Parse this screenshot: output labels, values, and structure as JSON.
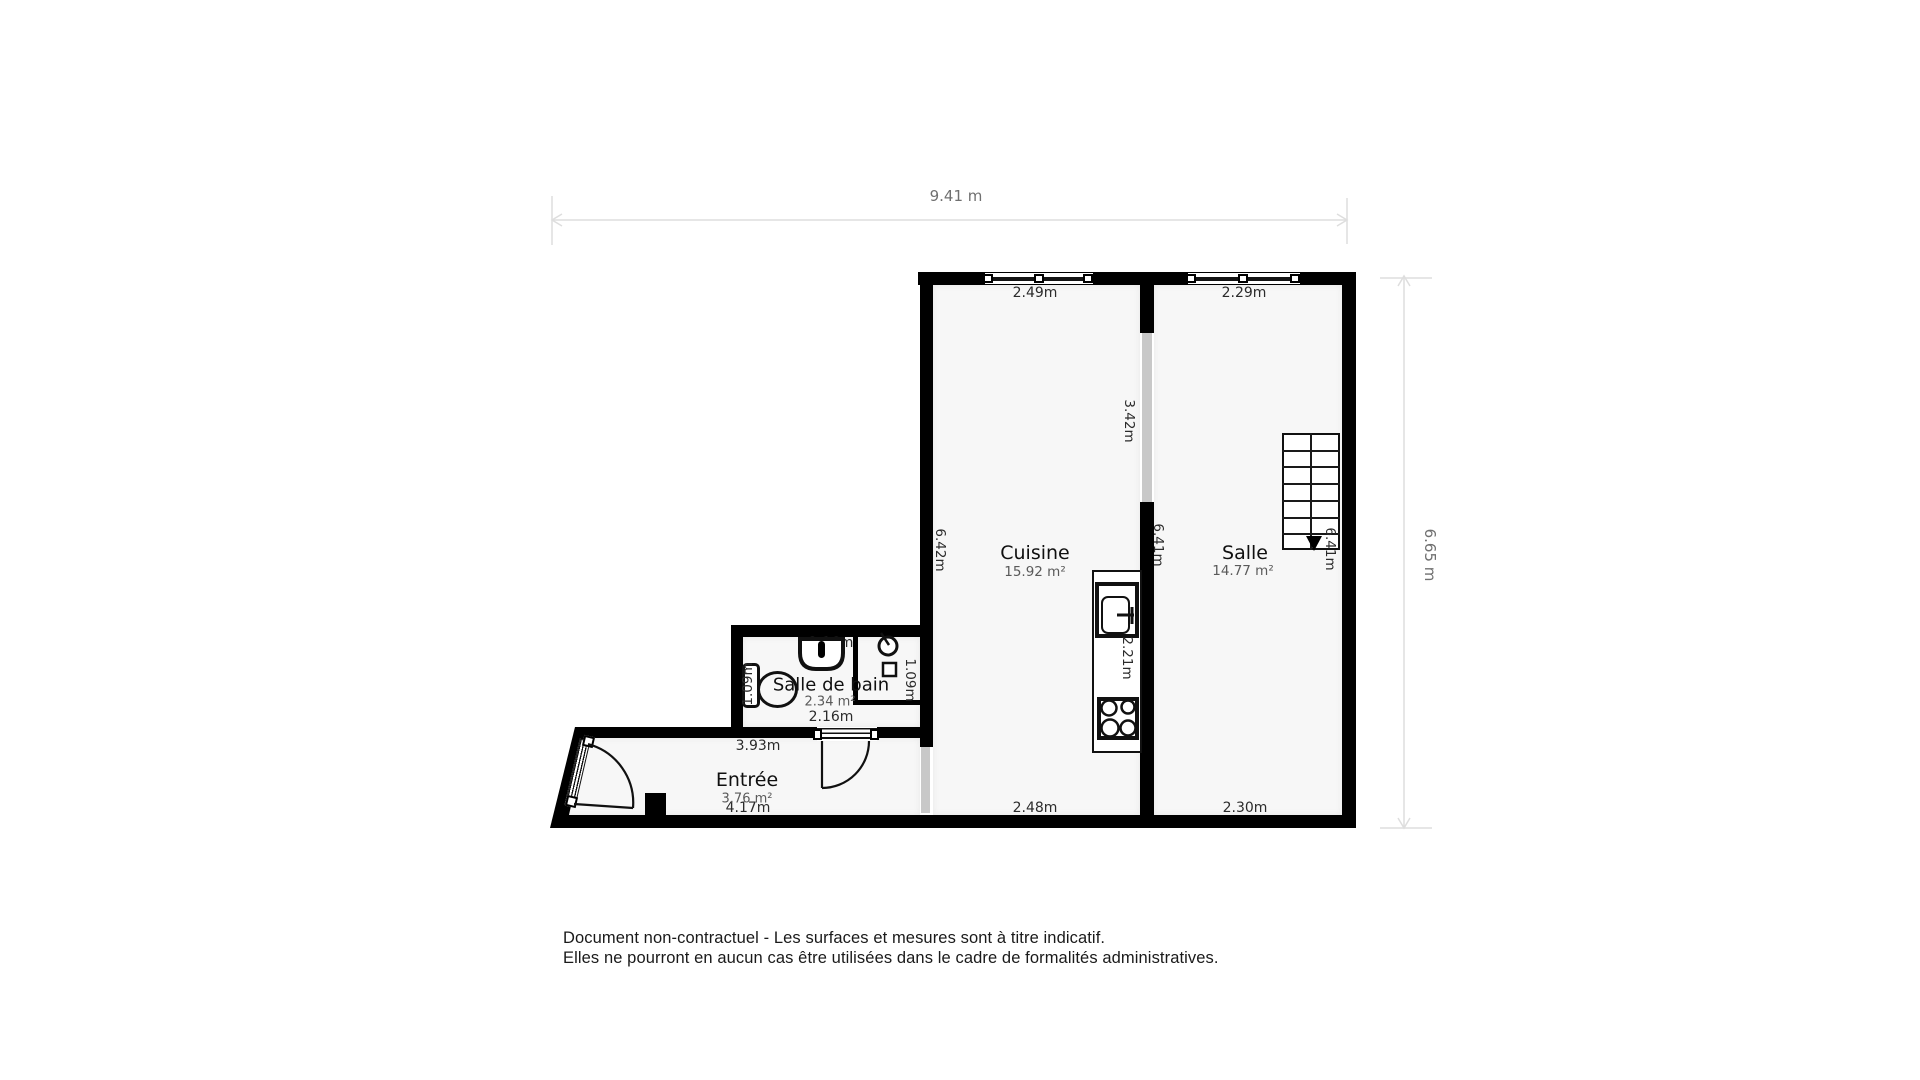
{
  "dimensions": {
    "top": "9.41 m",
    "right": "6.65 m"
  },
  "rooms": {
    "cuisine": {
      "name": "Cuisine",
      "area": "15.92 m²",
      "window": "2.49m",
      "wall_left": "6.42m",
      "wall_bottom": "2.48m",
      "opening": "3.42m",
      "counter": "2.21m"
    },
    "salle": {
      "name": "Salle",
      "area": "14.77 m²",
      "window": "2.29m",
      "wall_left": "6.41m",
      "wall_right": "6.41m",
      "wall_bottom": "2.30m"
    },
    "salle_de_bain": {
      "name": "Salle de bain",
      "area": "2.34 m²",
      "width_top": "2.16m",
      "width_bottom": "2.16m",
      "depth_left": "1.09m",
      "depth_right": "1.09m"
    },
    "entree": {
      "name": "Entrée",
      "area": "3.76 m²",
      "width": "4.17m",
      "wall_top": "3.93m"
    }
  },
  "footer": {
    "line1": "Document non-contractuel - Les surfaces et mesures sont à titre indicatif.",
    "line2": "Elles ne pourront en aucun cas être utilisées dans le cadre de formalités administratives."
  },
  "colors": {
    "wall": "#000000",
    "room_fill": "#f7f7f7",
    "opening": "#c8c8c8",
    "dim_line": "#e0e0e0",
    "dim_text": "#707070",
    "label_text": "#2b2b2b",
    "area_text": "#5a5a5a"
  }
}
